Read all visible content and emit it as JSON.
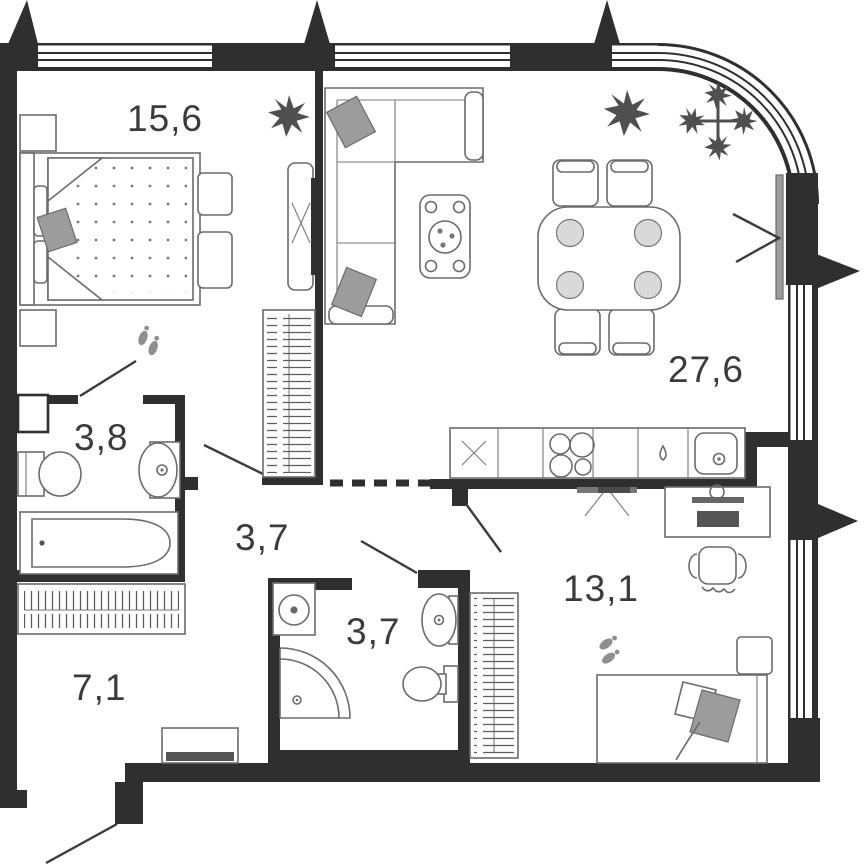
{
  "plan": {
    "title": "apartment-floor-plan",
    "rooms": {
      "bedroom": {
        "name": "bedroom",
        "area": "15,6"
      },
      "living_kitchen": {
        "name": "living-kitchen",
        "area": "27,6"
      },
      "bath_ensuite": {
        "name": "ensuite-bathroom",
        "area": "3,8"
      },
      "corridor": {
        "name": "corridor",
        "area": "3,7"
      },
      "bath_small": {
        "name": "small-bathroom",
        "area": "3,7"
      },
      "room2": {
        "name": "second-room",
        "area": "13,1"
      },
      "hallway": {
        "name": "entrance-hall",
        "area": "7,1"
      }
    },
    "furniture": {
      "bedroom": [
        "double-bed",
        "nightstand",
        "nightstand",
        "bench",
        "tv-unit",
        "plant",
        "footprints"
      ],
      "living_kitchen": [
        "corner-sofa",
        "coffee-table",
        "dining-table",
        "chair",
        "chair",
        "chair",
        "chair",
        "plant",
        "plant",
        "kitchen-counter",
        "stove",
        "kitchen-sink",
        "radiator",
        "wardrobe"
      ],
      "bath_ensuite": [
        "toilet",
        "washbasin",
        "bathtub",
        "duct-shaft"
      ],
      "bath_small": [
        "washing-machine",
        "shower",
        "washbasin",
        "toilet"
      ],
      "room2": [
        "desk",
        "monitor",
        "office-chair",
        "single-bed",
        "nightstand",
        "wardrobe",
        "tv-bracket",
        "footprints"
      ],
      "hallway": [
        "closet",
        "shoe-bench"
      ]
    },
    "colors": {
      "wall": "#2f2f2f",
      "furniture_line": "#6b6b6b",
      "accent_gray": "#9c9c9c",
      "plant": "#4f4f4f",
      "label": "#3b3b3b",
      "background": "#ffffff"
    }
  }
}
